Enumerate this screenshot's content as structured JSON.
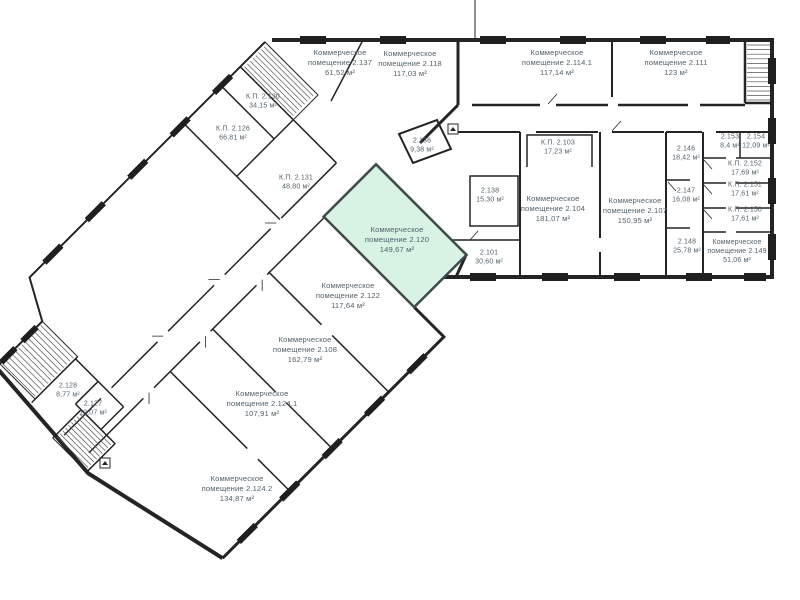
{
  "colors": {
    "wall": "#242424",
    "label_text": "#52616b",
    "highlight_fill": "#d8f2e3",
    "highlight_stroke": "#3e4b4b"
  },
  "icons": [
    {
      "name": "elevator-icon"
    },
    {
      "name": "elevator-icon"
    }
  ],
  "rooms": [
    {
      "id": "2.137",
      "name": "Коммерческое\nпомещение 2.137",
      "area": "61,52 м²"
    },
    {
      "id": "2.118",
      "name": "Коммерческое\nпомещение 2.118",
      "area": "117,03 м²"
    },
    {
      "id": "2.114.1",
      "name": "Коммерческое\nпомещение 2.114.1",
      "area": "117,14 м²"
    },
    {
      "id": "2.111",
      "name": "Коммерческое\nпомещение 2.111",
      "area": "123 м²"
    },
    {
      "id": "2.130",
      "name": "К.П. 2.130",
      "area": "34,15 м²"
    },
    {
      "id": "2.126",
      "name": "К.П. 2.126",
      "area": "66,81 м²"
    },
    {
      "id": "2.131",
      "name": "К.П. 2.131",
      "area": "48,80 м²"
    },
    {
      "id": "2.136",
      "name": "2.136",
      "area": "9,38 м²"
    },
    {
      "id": "2.103",
      "name": "К.П. 2.103",
      "area": "17,23 м²"
    },
    {
      "id": "2.138",
      "name": "2.138",
      "area": "15,30 м²"
    },
    {
      "id": "2.104",
      "name": "Коммерческое\nпомещение 2.104",
      "area": "181,07 м²"
    },
    {
      "id": "2.107",
      "name": "Коммерческое\nпомещение 2.107",
      "area": "150,95 м²"
    },
    {
      "id": "2.146",
      "name": "2.146",
      "area": "18,42 м²"
    },
    {
      "id": "2.153",
      "name": "2.153",
      "area": "8,4 м²"
    },
    {
      "id": "2.154",
      "name": "2.154",
      "area": "12,09 м²"
    },
    {
      "id": "2.152",
      "name": "К.П. 2.152",
      "area": "17,69 м²"
    },
    {
      "id": "2.147",
      "name": "2.147",
      "area": "16,08 м²"
    },
    {
      "id": "2.151",
      "name": "К.П. 2.151",
      "area": "17,61 м²"
    },
    {
      "id": "2.150",
      "name": "К.П. 2.150",
      "area": "17,61 м²"
    },
    {
      "id": "2.101",
      "name": "2.101",
      "area": "30,60 м²"
    },
    {
      "id": "2.148",
      "name": "2.148",
      "area": "25,78 м²"
    },
    {
      "id": "2.149",
      "name": "Коммерческое\nпомещение 2.149",
      "area": "51,06 м²"
    },
    {
      "id": "2.120",
      "name": "Коммерческое\nпомещение 2.120",
      "area": "149,67 м²",
      "highlighted": true
    },
    {
      "id": "2.122",
      "name": "Коммерческое\nпомещение 2.122",
      "area": "117,64 м²"
    },
    {
      "id": "2.108",
      "name": "Коммерческое\nпомещение 2.108",
      "area": "162,79 м²"
    },
    {
      "id": "2.124.1",
      "name": "Коммерческое\nпомещение 2.124.1",
      "area": "107,91 м²"
    },
    {
      "id": "2.124.2",
      "name": "Коммерческое\nпомещение 2.124.2",
      "area": "134,87 м²"
    },
    {
      "id": "2.128",
      "name": "2.128",
      "area": "8,77 м²"
    },
    {
      "id": "2.127",
      "name": "2.127",
      "area": "12,07 м²"
    }
  ]
}
